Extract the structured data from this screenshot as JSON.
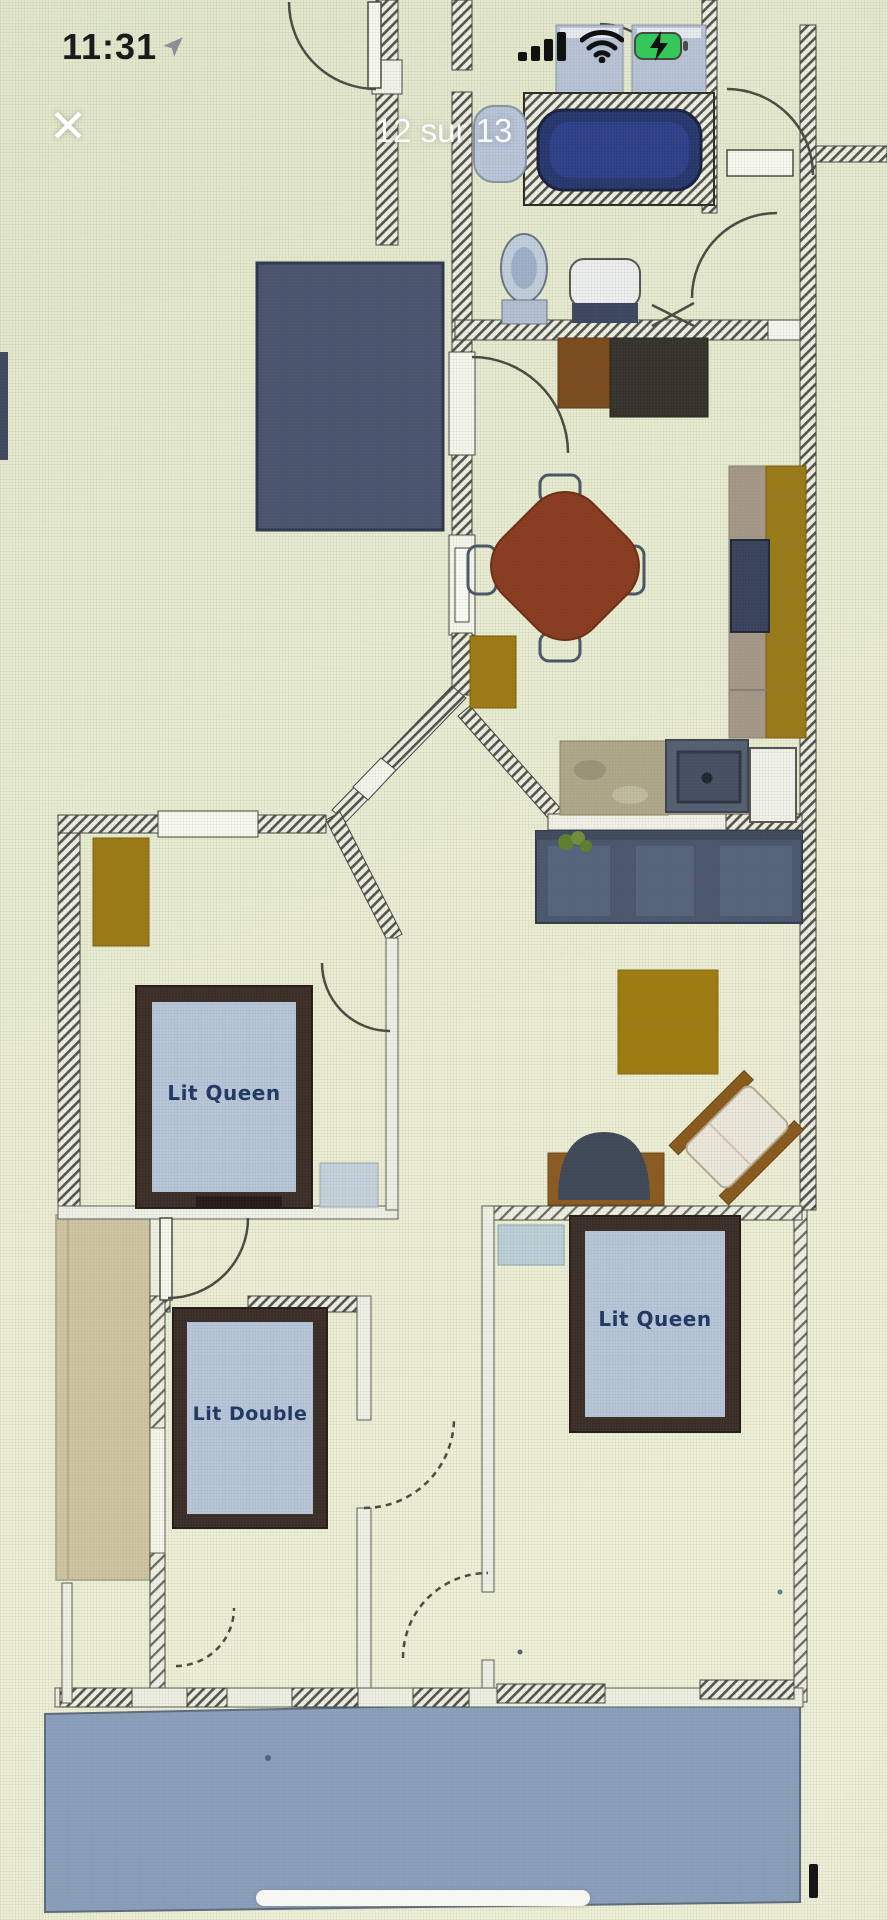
{
  "status_bar": {
    "time": "11:31"
  },
  "viewer": {
    "title": "12 sur 13",
    "close_glyph": "✕"
  },
  "floor_plan": {
    "beds": [
      {
        "label": "Lit Queen"
      },
      {
        "label": "Lit Queen"
      },
      {
        "label": "Lit Double"
      }
    ],
    "colors": {
      "background": "#e8ecd3",
      "wall_hatch": "#4c4c46",
      "bathtub": "#26366f",
      "bed_frame": "#372a24",
      "bed_mattress": "#b6c5d9",
      "bed_label_text": "#1f3766",
      "terrace": "#8ba0bf",
      "left_balcony": "#cfc5a3",
      "dining_table": "#8a3a1e",
      "accent_gold": "#a07c10",
      "kitchen_cabinets": "#49566e",
      "navy_room": "#49536f",
      "battery_green": "#34c759"
    }
  }
}
